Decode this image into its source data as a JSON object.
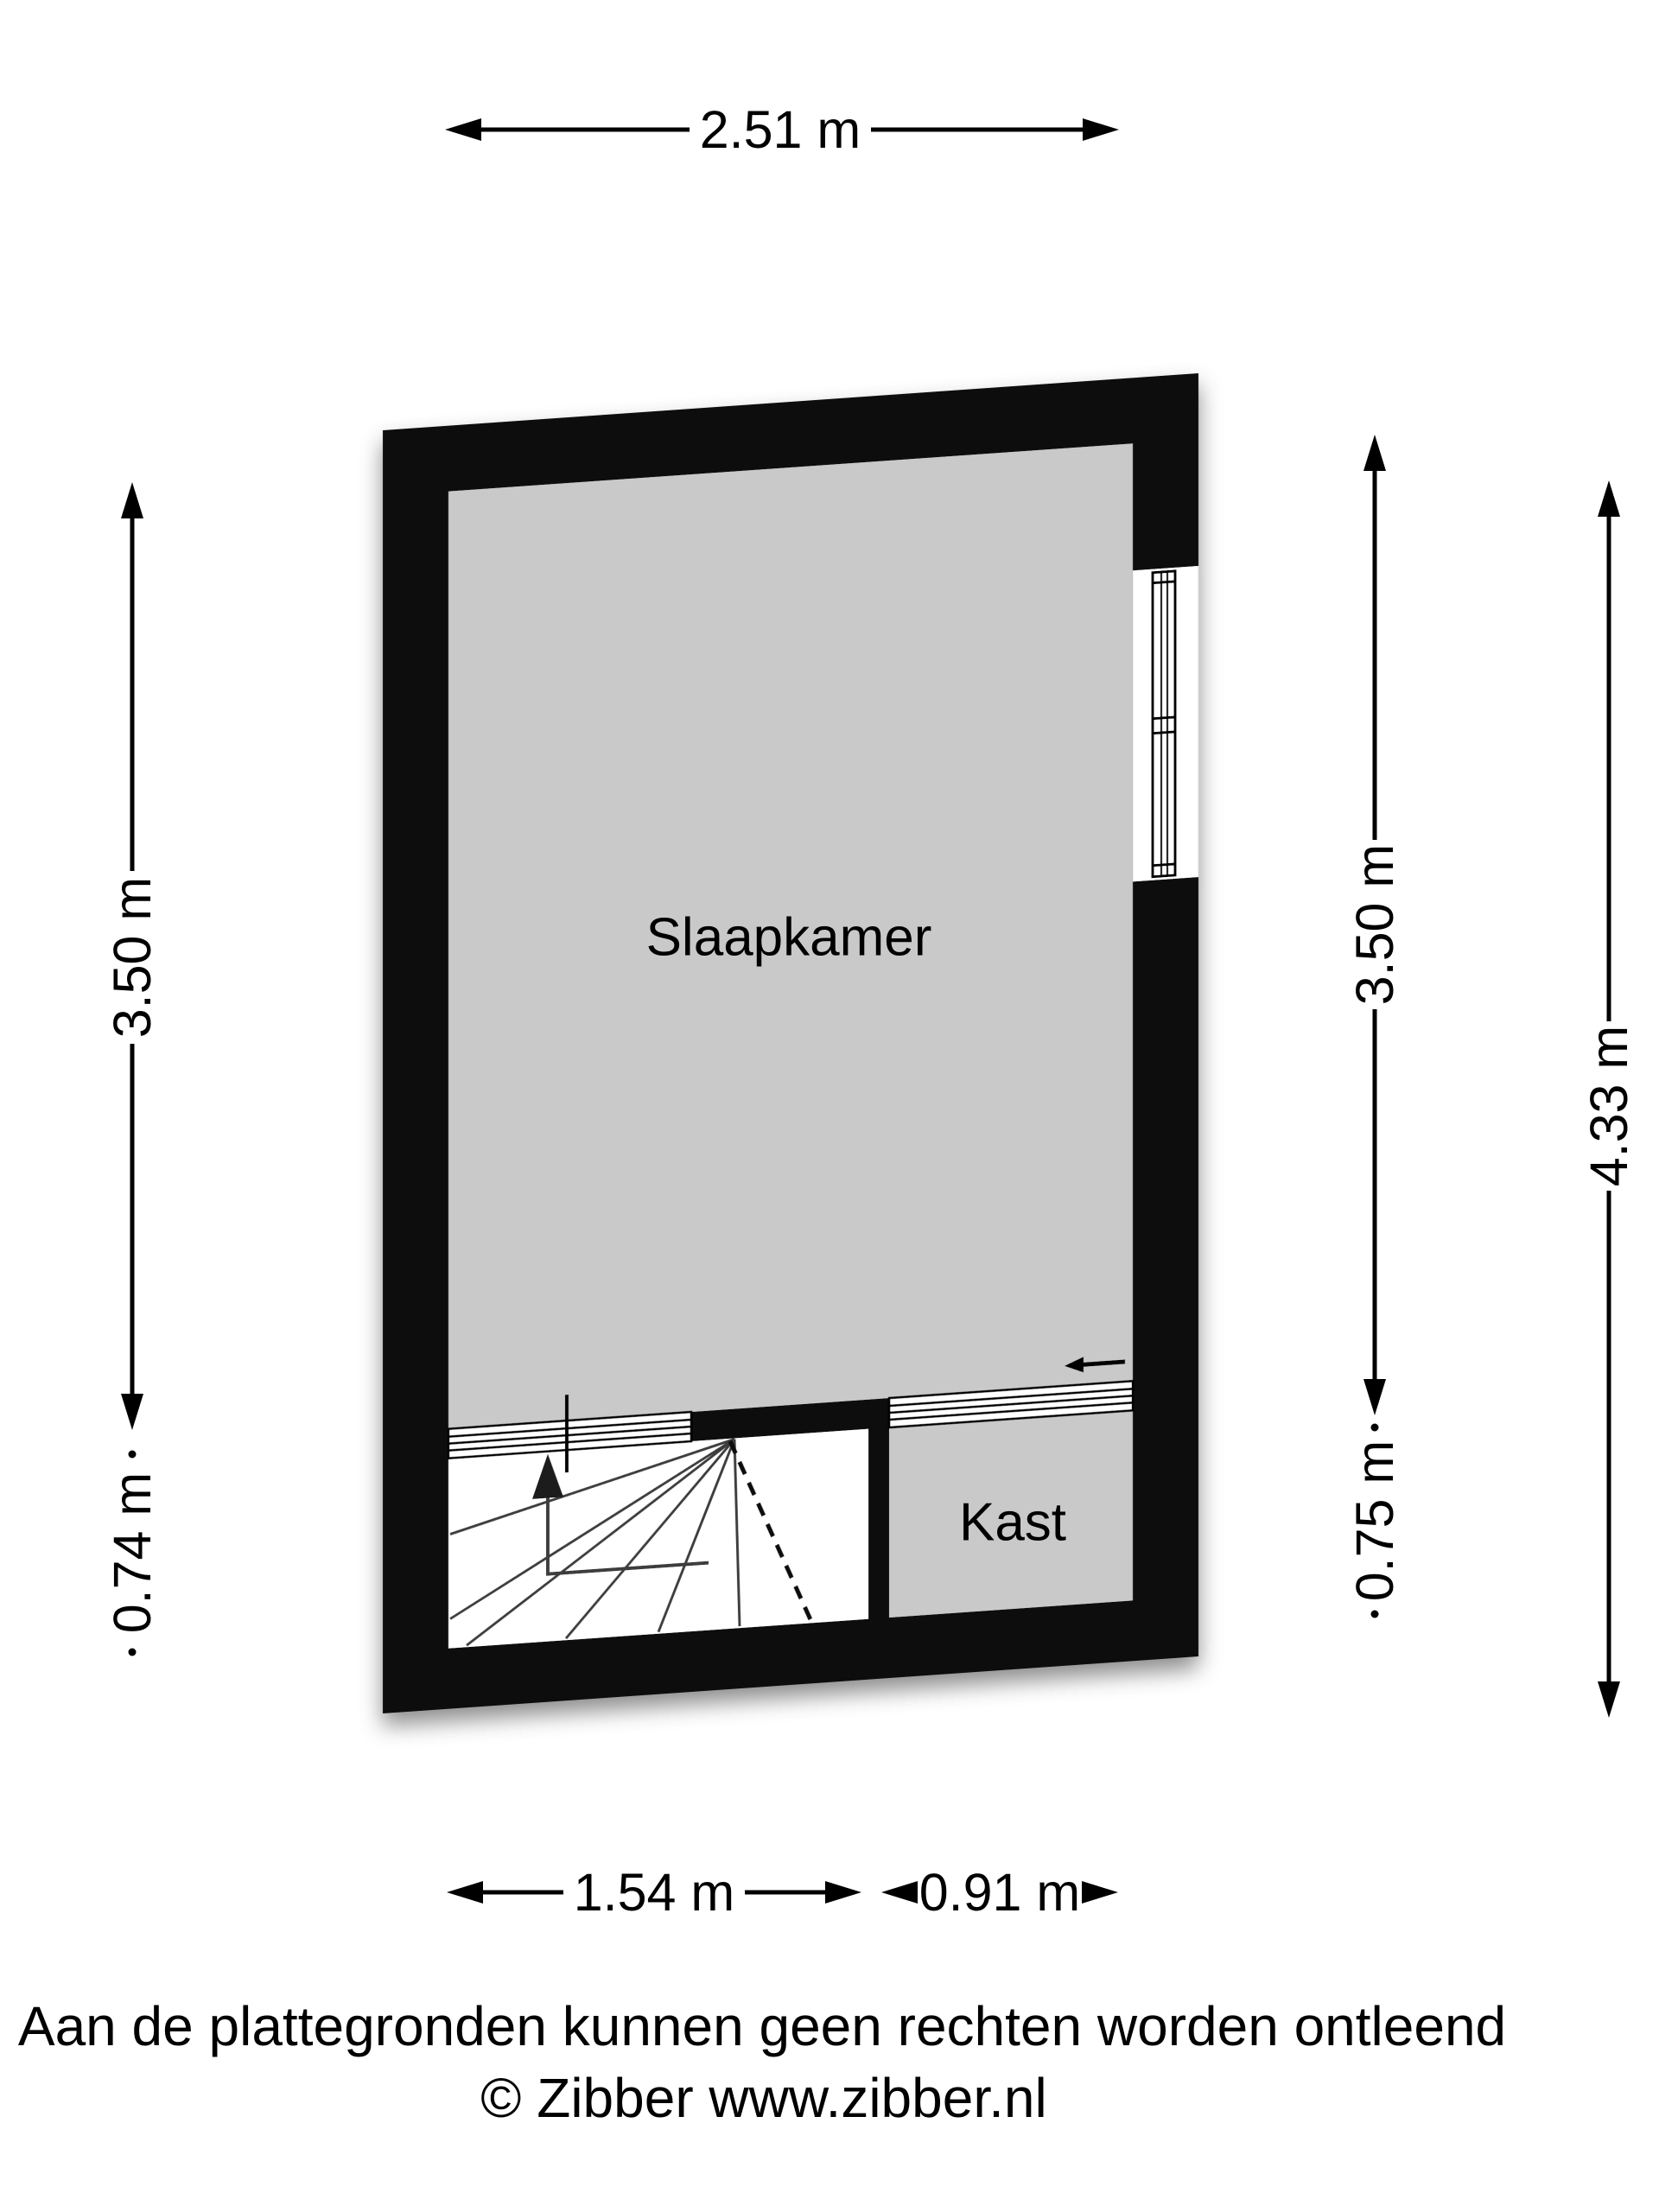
{
  "floorplan": {
    "rooms": {
      "bedroom_label": "Slaapkamer",
      "closet_label": "Kast"
    },
    "dimensions": {
      "top_width": "2.51 m",
      "left_room_height": "3.50 m",
      "left_stair_depth": "0.74 m",
      "right_room_height": "3.50 m",
      "right_closet_depth": "0.75 m",
      "overall_height": "4.33 m",
      "bottom_stair_width": "1.54 m",
      "bottom_closet_width": "0.91 m"
    },
    "colors": {
      "wall": "#0b0b0b",
      "room_fill": "#c9c9c9",
      "stairwell_fill": "#ffffff",
      "window_fill": "#ffffff",
      "background": "#ffffff"
    },
    "symbols": {
      "window": "window-symbol",
      "stairs": "winder-stairs-up",
      "stair_direction": "up-arrow",
      "sliding_door": "sliding-door-arrow-left"
    },
    "footer": {
      "disclaimer": "Aan de plattegronden kunnen geen rechten worden ontleend",
      "credit": "© Zibber www.zibber.nl"
    }
  }
}
